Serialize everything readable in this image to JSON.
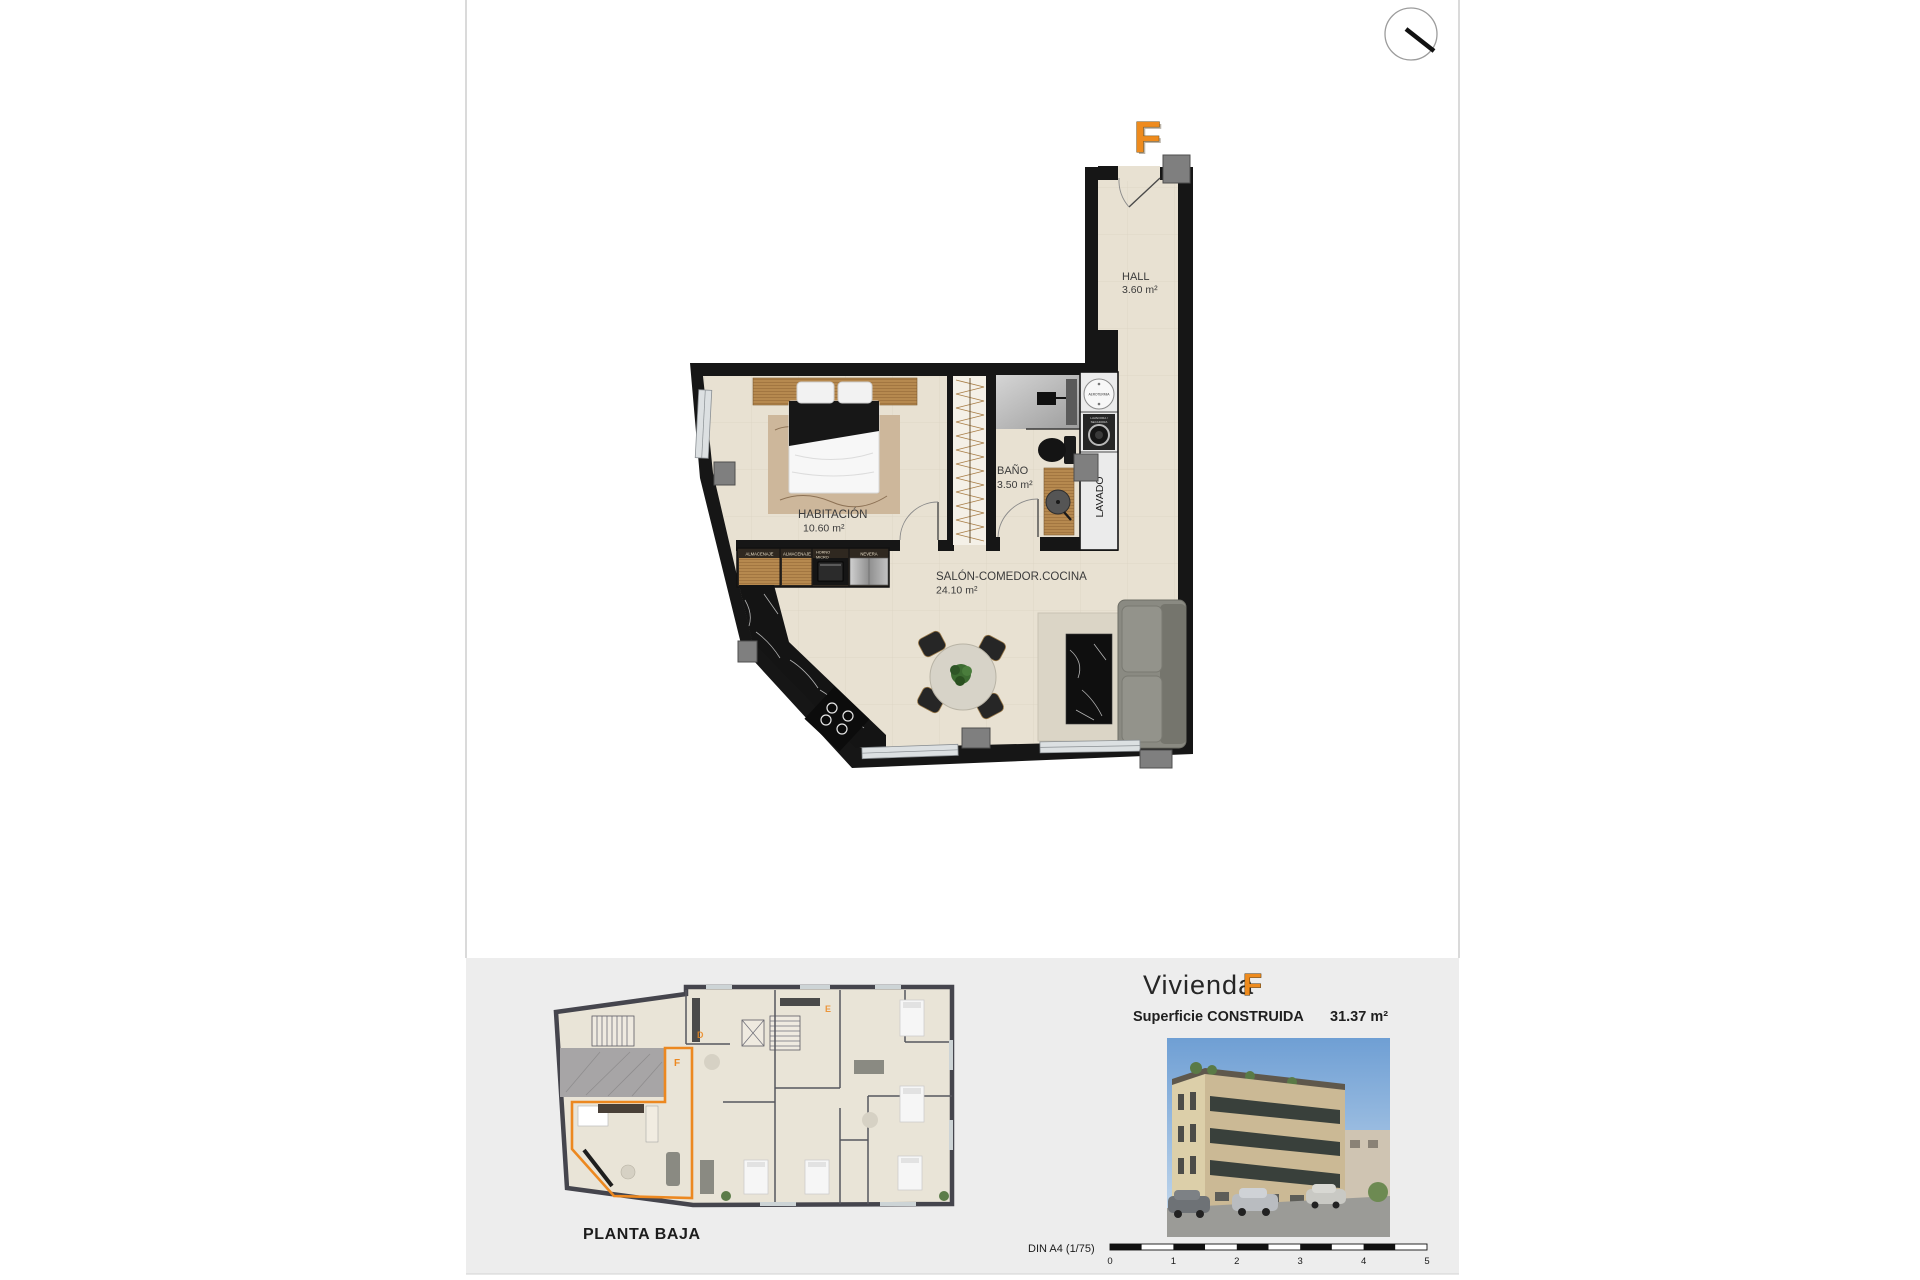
{
  "colors": {
    "accent_orange": "#ee8b1e",
    "wall_black": "#161616",
    "floor_beige": "#e8e1d2",
    "floor_grid": "#cfc8b6",
    "footer_band": "#ededed",
    "mini_wall": "#45454d"
  },
  "plan": {
    "unit_letter": "F",
    "rooms": {
      "hall": {
        "name": "HALL",
        "area": "3.60 m²"
      },
      "bath": {
        "name": "BAÑO",
        "area": "3.50 m²"
      },
      "bedroom": {
        "name": "HABITACIÓN",
        "area": "10.60 m²"
      },
      "living": {
        "name": "SALÓN-COMEDOR.COCINA",
        "area": "24.10 m²"
      },
      "laundry": {
        "name": "LAVADO"
      }
    },
    "labels": {
      "aerotermia": "AEROTERMIA",
      "washer_line1": "LAVADORA /",
      "washer_line2": "SECADORA",
      "cabinets": [
        {
          "l1": "ALMACENAJE"
        },
        {
          "l1": "ALMACENAJE"
        },
        {
          "l1": "HORNO",
          "l2": "MICRO"
        },
        {
          "l1": "NEVERA"
        }
      ]
    }
  },
  "footer": {
    "plan_title": "PLANTA BAJA",
    "unit_word": "Vivienda",
    "unit_letter": "F",
    "surface_label": "Superficie CONSTRUIDA",
    "surface_value": "31.37 m²",
    "scale_label": "DIN A4 (1/75)",
    "scale_ticks": [
      "0",
      "1",
      "2",
      "3",
      "4",
      "5"
    ],
    "mini_letters": {
      "d": "D",
      "e": "E",
      "f": "F"
    }
  }
}
